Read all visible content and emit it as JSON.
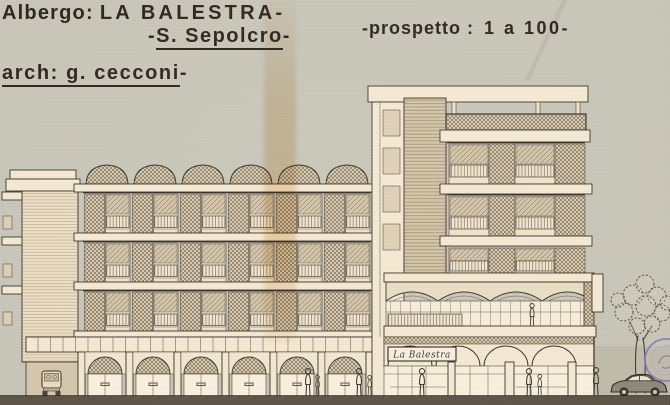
{
  "title_block": {
    "hotel_label": "Albergo:",
    "hotel_name": "LA BALESTRA",
    "dash1": "-",
    "dash_l2_left": "-",
    "location": "S. Sepolcro",
    "dash_l2_right": "-",
    "scale_label": "-prospetto :",
    "scale_value": "1 a 100",
    "scale_dash": "-",
    "architect": "arch: g. cecconi",
    "architect_dash": "-"
  },
  "building": {
    "sign_text": "La Balestra"
  },
  "palette": {
    "paper": "#c7c5b7",
    "drawing_cream": "#f4e8d1",
    "ink": "#383027",
    "hatch_tone": "#6e6253",
    "ground_strip": "#695f4f",
    "stamp_purple": "#7b73bd",
    "stain_amber": "#c98d2b"
  }
}
